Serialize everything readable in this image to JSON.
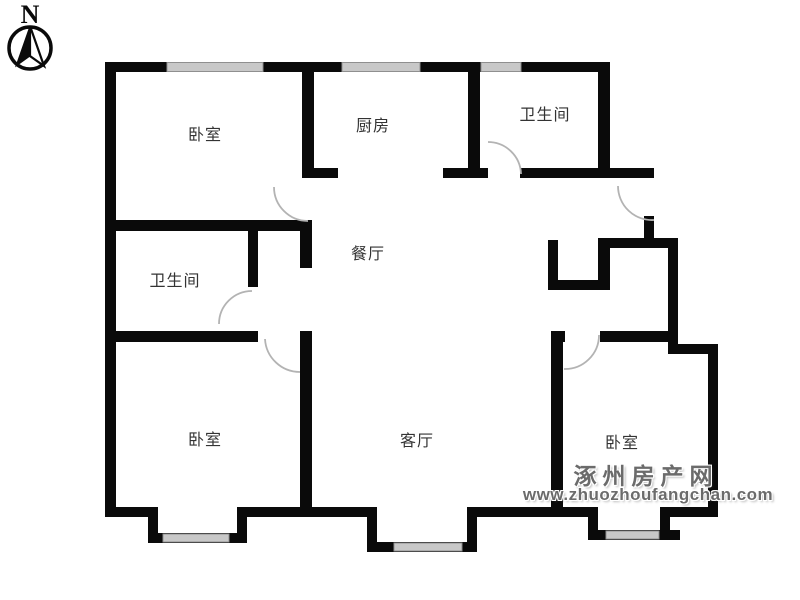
{
  "compass": {
    "label": "N"
  },
  "rooms": [
    {
      "id": "bedroom-nw",
      "name": "卧室"
    },
    {
      "id": "kitchen",
      "name": "厨房"
    },
    {
      "id": "bathroom-ne",
      "name": "卫生间"
    },
    {
      "id": "dining-room",
      "name": "餐厅"
    },
    {
      "id": "bathroom-west",
      "name": "卫生间"
    },
    {
      "id": "bedroom-sw",
      "name": "卧室"
    },
    {
      "id": "living-room",
      "name": "客厅"
    },
    {
      "id": "bedroom-se",
      "name": "卧室"
    }
  ],
  "watermark": {
    "site_name": "涿州房产网",
    "site_url": "www.zhuozhoufangchan.com"
  },
  "colors": {
    "wall": "#0a0a0a",
    "window_glass": "#c8c8c8",
    "door_arc": "#b3b3b3",
    "room_label": "#333333",
    "watermark": "#6b6b6b",
    "background": "#ffffff"
  }
}
